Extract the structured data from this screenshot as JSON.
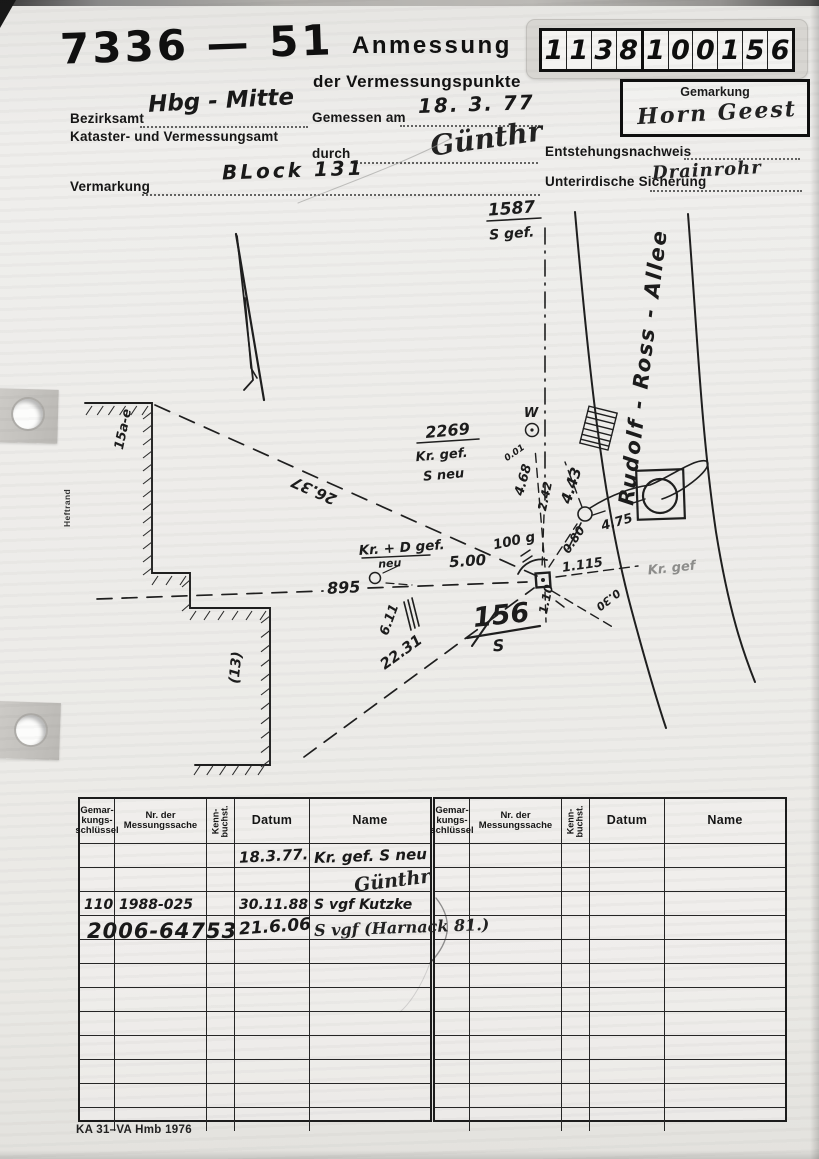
{
  "document": {
    "doc_number": "7336 — 51",
    "title": "Anmessung",
    "subtitle": "der Vermessungspunkte",
    "id_digits": "1138100156",
    "gemarkung_label": "Gemarkung",
    "gemarkung_value": "Horn Geest",
    "heftrand": "Heftrand",
    "footer": "KA 31–VA Hmb 1976",
    "fields": {
      "bezirksamt_label": "Bezirksamt",
      "bezirksamt_value": "Hbg - Mitte",
      "amt_label": "Kataster- und Vermessungsamt",
      "gemessen_label": "Gemessen am",
      "gemessen_value": "18. 3. 77",
      "durch_label": "durch",
      "durch_value": "Günthr",
      "vermarkung_label": "Vermarkung",
      "vermarkung_value": "BLock 131",
      "entstehung_label": "Entstehungsnachweis",
      "entstehung_value": "",
      "sicherung_label": "Unterirdische Sicherung",
      "sicherung_value": "Drainrohr"
    }
  },
  "sketch": {
    "street_name": "Rudolf - Ross - Allee",
    "labels": [
      {
        "text": "1587",
        "x": 512,
        "y": 214,
        "rot": -4,
        "size": 17
      },
      {
        "text": "S gef.",
        "x": 512,
        "y": 238,
        "rot": -4,
        "size": 14
      },
      {
        "text": "Rudolf - Ross - Allee",
        "x": 650,
        "y": 368,
        "rot": -83,
        "size": 21,
        "ls": 2
      },
      {
        "text": "2269",
        "x": 448,
        "y": 436,
        "rot": -5,
        "size": 16
      },
      {
        "text": "Kr. gef.",
        "x": 442,
        "y": 459,
        "rot": -5,
        "size": 13
      },
      {
        "text": "S neu",
        "x": 444,
        "y": 479,
        "rot": -5,
        "size": 13
      },
      {
        "text": "W",
        "x": 531,
        "y": 417,
        "rot": 0,
        "size": 13
      },
      {
        "text": "0.01",
        "x": 516,
        "y": 455,
        "rot": -35,
        "size": 9
      },
      {
        "text": "4.68",
        "x": 527,
        "y": 481,
        "rot": -74,
        "size": 13
      },
      {
        "text": "2.42",
        "x": 549,
        "y": 497,
        "rot": -78,
        "size": 12
      },
      {
        "text": "4.43",
        "x": 576,
        "y": 487,
        "rot": -72,
        "size": 15
      },
      {
        "text": "4.75",
        "x": 618,
        "y": 526,
        "rot": -16,
        "size": 13
      },
      {
        "text": "0.80",
        "x": 577,
        "y": 542,
        "rot": -56,
        "size": 12
      },
      {
        "text": "100 g",
        "x": 515,
        "y": 545,
        "rot": -12,
        "size": 13.5
      },
      {
        "text": "5.00",
        "x": 468,
        "y": 566,
        "rot": -4,
        "size": 15
      },
      {
        "text": "1.115",
        "x": 583,
        "y": 569,
        "rot": -8,
        "size": 13
      },
      {
        "text": "1.10",
        "x": 550,
        "y": 600,
        "rot": -78,
        "size": 12
      },
      {
        "text": "0.30",
        "x": 606,
        "y": 597,
        "rot": 142,
        "size": 11
      },
      {
        "text": "Kr. gef",
        "x": 672,
        "y": 572,
        "rot": -6,
        "size": 13,
        "cls": "pencil"
      },
      {
        "text": "Kr. + D gef.",
        "x": 402,
        "y": 552,
        "rot": -4,
        "size": 13.5
      },
      {
        "text": "neu",
        "x": 390,
        "y": 567,
        "rot": -4,
        "size": 11
      },
      {
        "text": "895",
        "x": 344,
        "y": 593,
        "rot": -3,
        "size": 16
      },
      {
        "text": "26.37",
        "x": 316,
        "y": 486,
        "rot": -156,
        "size": 15
      },
      {
        "text": "22.31",
        "x": 404,
        "y": 656,
        "rot": -36,
        "size": 15
      },
      {
        "text": "6.11",
        "x": 393,
        "y": 621,
        "rot": -70,
        "size": 13
      },
      {
        "text": "156",
        "x": 502,
        "y": 624,
        "rot": -6,
        "size": 27
      },
      {
        "text": "S",
        "x": 499,
        "y": 651,
        "rot": -5,
        "size": 16
      },
      {
        "text": "(13)",
        "x": 240,
        "y": 668,
        "rot": -84,
        "size": 14
      },
      {
        "text": "15a-e",
        "x": 127,
        "y": 430,
        "rot": -78,
        "size": 13
      }
    ]
  },
  "table": {
    "headers": [
      "Gemar-\nkungs-\nschlüssel",
      "Nr. der\nMessungssache",
      "Kenn-\nbuchst.",
      "Datum",
      "Name"
    ],
    "row_count": 12,
    "left_entries": [
      {
        "row": 0,
        "col": 3,
        "text": "18.3.77."
      },
      {
        "row": 0,
        "col": 4,
        "text": "Kr. gef. S neu"
      },
      {
        "row": 1,
        "col": 4,
        "text": "Günthr"
      },
      {
        "row": 2,
        "col": 0,
        "text": "110"
      },
      {
        "row": 2,
        "col": 1,
        "text": "1988-025"
      },
      {
        "row": 2,
        "col": 3,
        "text": "30.11.88"
      },
      {
        "row": 2,
        "col": 4,
        "text": "S vgf Kutzke"
      },
      {
        "row": 3,
        "col": 1,
        "text": "2006-64753"
      },
      {
        "row": 3,
        "col": 3,
        "text": "21.6.06"
      },
      {
        "row": 3,
        "col": 4,
        "text": "S vgf (Harnack 81.)"
      }
    ],
    "right_entries": []
  }
}
